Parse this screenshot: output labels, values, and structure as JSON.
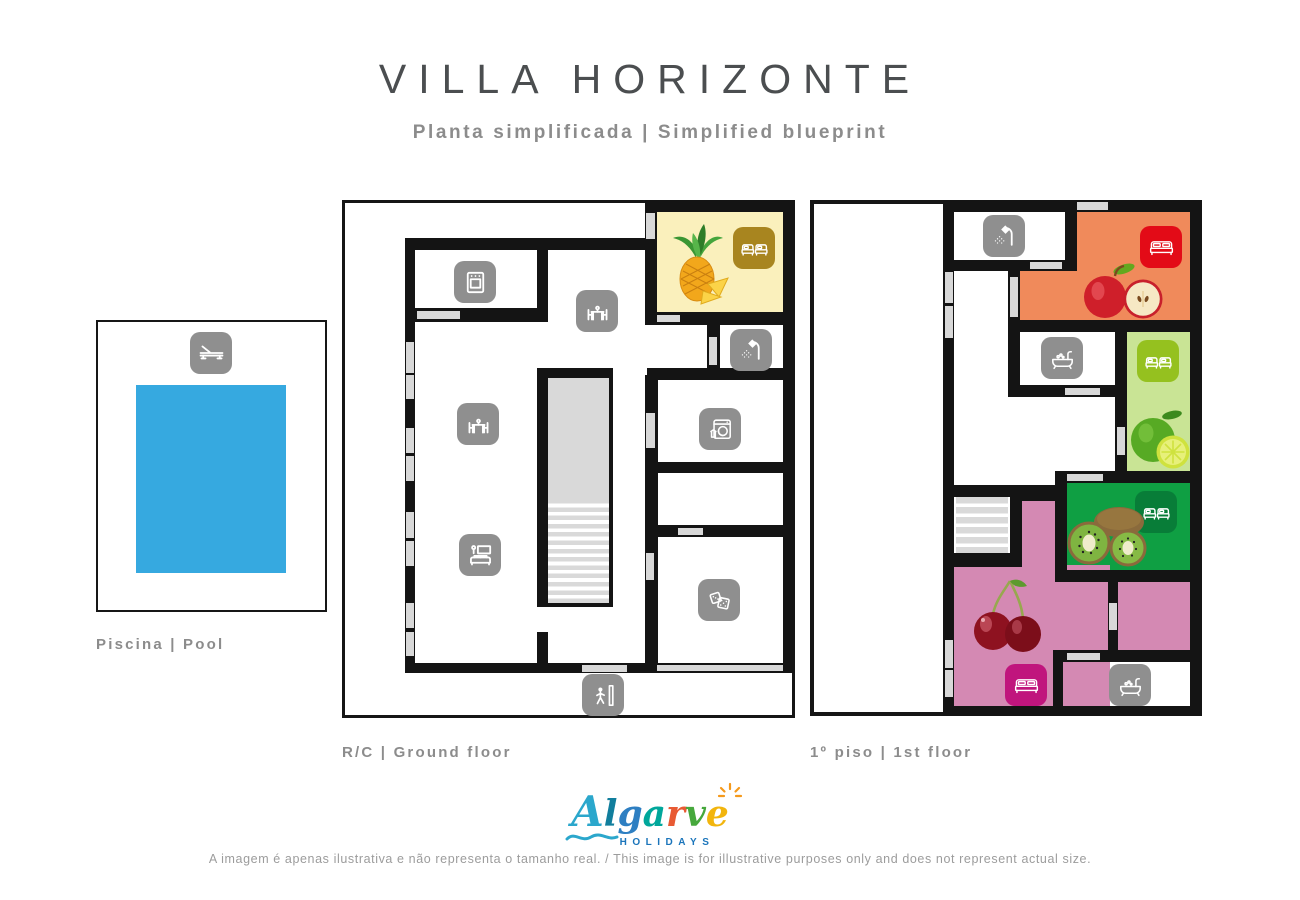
{
  "header": {
    "title": "VILLA HORIZONTE",
    "subtitle": "Planta simplificada | Simplified blueprint"
  },
  "pool": {
    "label": "Piscina | Pool",
    "water_color": "#36a9e0",
    "icon": "sun-lounger-icon"
  },
  "floors": {
    "ground": {
      "label": "R/C | Ground floor",
      "rooms": [
        {
          "name": "Pineapple bedroom",
          "fill": "#faf0bc",
          "bed_icon": "twin-beds-icon",
          "bed_icon_color": "#a8851f",
          "fruit": "pineapple"
        },
        {
          "name": "Kitchen",
          "icon": "oven-icon"
        },
        {
          "name": "Dining area",
          "icon": "dining-set-icon"
        },
        {
          "name": "Dining area 2",
          "icon": "dining-set-icon"
        },
        {
          "name": "Living room",
          "icon": "sofa-tv-icon"
        },
        {
          "name": "Shower room",
          "icon": "shower-icon"
        },
        {
          "name": "Laundry",
          "icon": "washing-machine-icon"
        },
        {
          "name": "Games room",
          "icon": "dice-icon"
        },
        {
          "name": "Entrance",
          "icon": "entrance-icon"
        },
        {
          "name": "Staircase"
        }
      ]
    },
    "first": {
      "label": "1º piso | 1st floor",
      "rooms": [
        {
          "name": "Shower room",
          "icon": "shower-icon"
        },
        {
          "name": "Apple bedroom",
          "fill": "#f08a5b",
          "bed_icon": "double-bed-icon",
          "bed_icon_color": "#e30b17",
          "fruit": "apple"
        },
        {
          "name": "Bathroom",
          "icon": "bathtub-icon"
        },
        {
          "name": "Lime bedroom",
          "fill": "#c9e495",
          "bed_icon": "twin-beds-icon",
          "bed_icon_color": "#95c11f",
          "fruit": "lime"
        },
        {
          "name": "Kiwi bedroom",
          "fill": "#0f9f43",
          "bed_icon": "twin-beds-icon",
          "bed_icon_color": "#087d38",
          "fruit": "kiwi"
        },
        {
          "name": "Cherry bedroom",
          "fill": "#d489b3",
          "bed_icon": "double-bed-icon",
          "bed_icon_color": "#c0157d",
          "fruit": "cherries"
        },
        {
          "name": "Bathroom 2",
          "icon": "bathtub-icon"
        },
        {
          "name": "Terrace"
        },
        {
          "name": "Staircase"
        }
      ]
    }
  },
  "logo": {
    "letters": [
      {
        "ch": "A",
        "color": "#2ba7cc",
        "size": 42
      },
      {
        "ch": "l",
        "color": "#117e9d",
        "size": 36
      },
      {
        "ch": "g",
        "color": "#2e7fc2",
        "size": 36
      },
      {
        "ch": "a",
        "color": "#00a79b",
        "size": 36
      },
      {
        "ch": "r",
        "color": "#e85a33",
        "size": 36
      },
      {
        "ch": "v",
        "color": "#46a83c",
        "size": 36
      },
      {
        "ch": "e",
        "color": "#f2b50d",
        "size": 36
      }
    ],
    "sub": "HOLIDAYS",
    "sub_color": "#1b75bb"
  },
  "footer": {
    "disclaimer": "A imagem é apenas ilustrativa e não representa o tamanho real. / This image is for illustrative purposes only and does not represent actual size."
  },
  "colors": {
    "wall": "#141414",
    "window": "#d8d8d8",
    "icon_gray": "#8f8f8f",
    "pool_water": "#36a9e0",
    "title_text": "#4b4e50",
    "muted_text": "#8c8c8c",
    "footer_text": "#9c9c9c"
  },
  "icons": {
    "sun-lounger-icon": "pool sun lounger",
    "oven-icon": "kitchen stove",
    "dining-set-icon": "table with two chairs",
    "sofa-tv-icon": "sofa with tv and lamp",
    "twin-beds-icon": "two single beds",
    "double-bed-icon": "double bed",
    "shower-icon": "shower head",
    "washing-machine-icon": "washing machine with shirt",
    "dice-icon": "two dice",
    "entrance-icon": "person at doorway",
    "bathtub-icon": "bathtub"
  }
}
